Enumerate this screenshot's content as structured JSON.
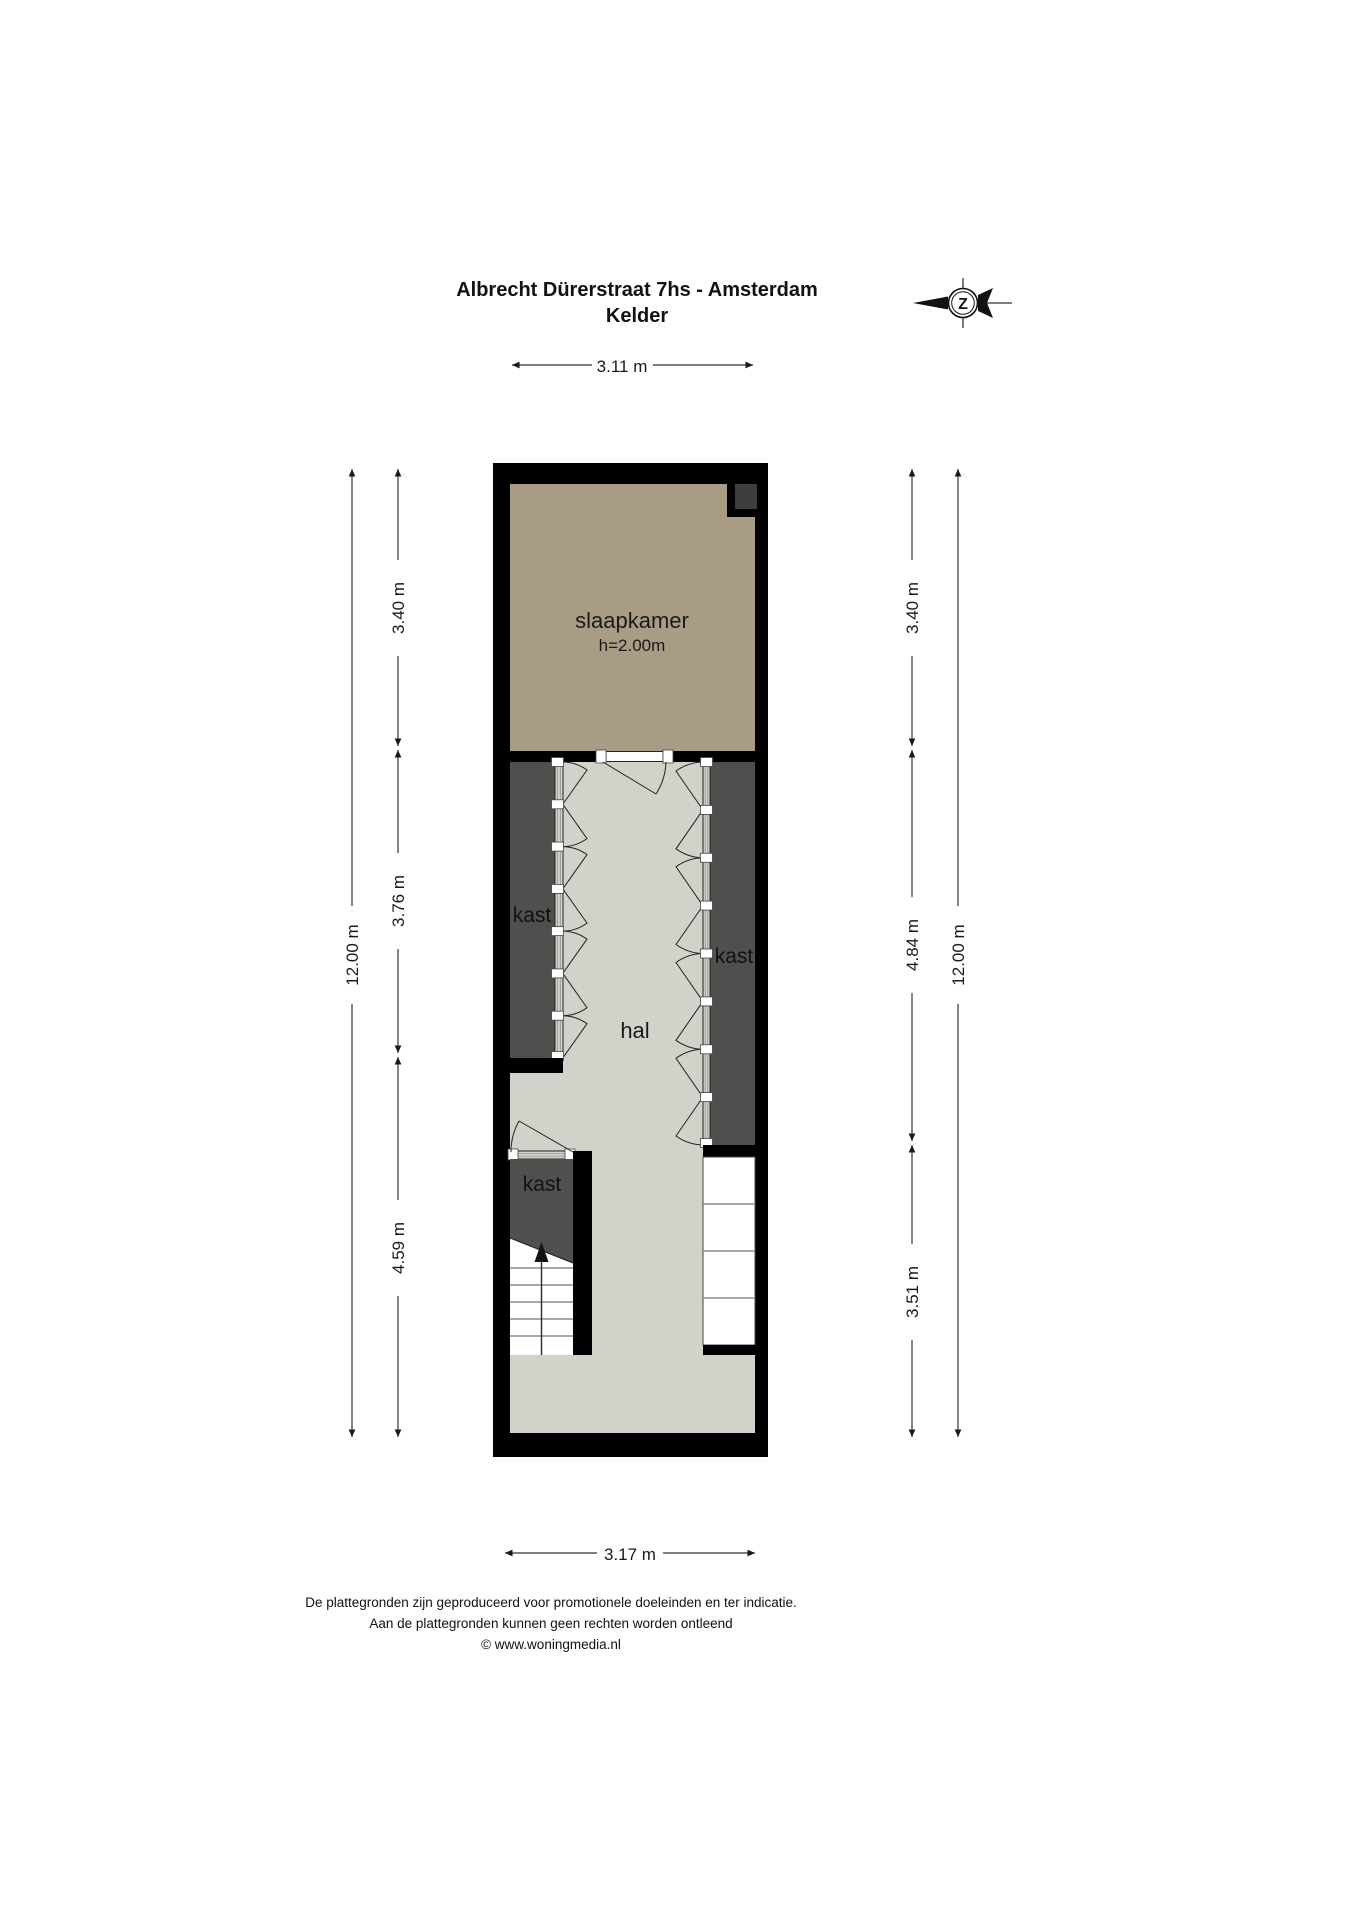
{
  "title": {
    "line1": "Albrecht Dürerstraat 7hs - Amsterdam",
    "line2": "Kelder"
  },
  "compass": {
    "north_letter": "Z"
  },
  "dimensions": {
    "top": "3.11 m",
    "bottom": "3.17 m",
    "left_overall": "12.00 m",
    "right_overall": "12.00 m",
    "left_segments": [
      "3.40 m",
      "3.76 m",
      "4.59 m"
    ],
    "right_segments": [
      "3.40 m",
      "4.84 m",
      "3.51 m"
    ]
  },
  "rooms": {
    "slaapkamer": {
      "label": "slaapkamer",
      "ceiling_height": "h=2.00m"
    },
    "hal": {
      "label": "hal"
    },
    "kast_left": {
      "label": "kast"
    },
    "kast_right": {
      "label": "kast"
    },
    "kast_bottom": {
      "label": "kast"
    }
  },
  "footer": {
    "line1": "De plattegronden zijn geproduceerd voor promotionele doeleinden en ter indicatie.",
    "line2": "Aan de plattegronden kunnen geen rechten worden ontleend",
    "line3": "© www.woningmedia.nl"
  },
  "colors": {
    "wall": "#000000",
    "bedroom_floor": "#a89c84",
    "hall_floor": "#d2d2ca",
    "closet_fill": "#4f4f4d",
    "shaft_fill": "#3d3d3d",
    "page_background": "#ffffff"
  }
}
